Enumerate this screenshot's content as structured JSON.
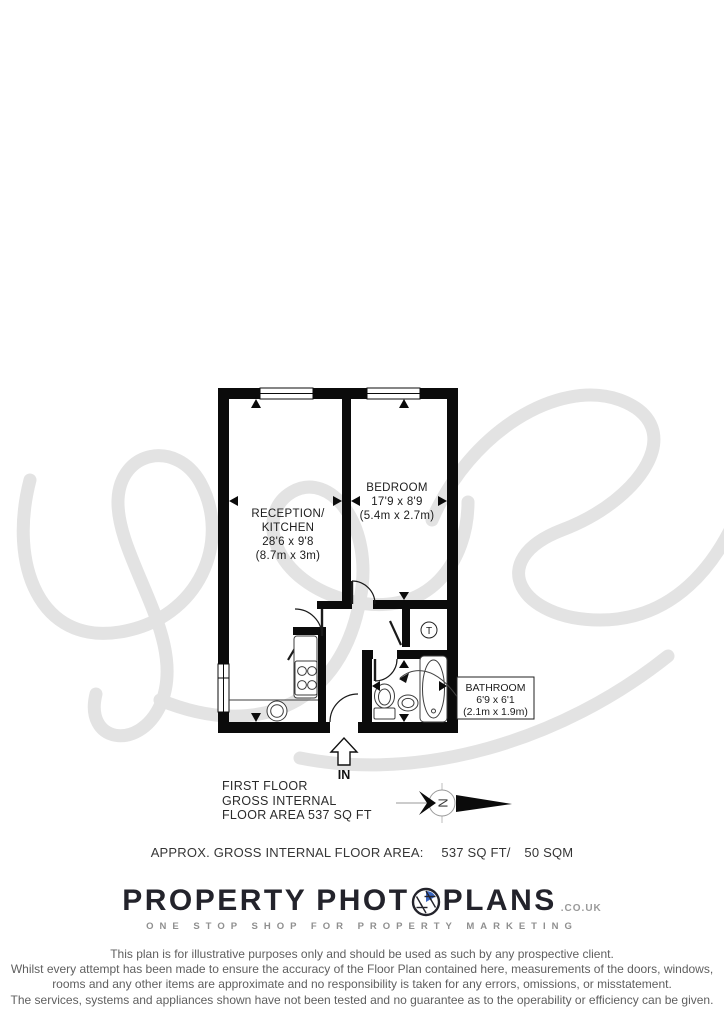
{
  "watermark_color": "#e3e3e3",
  "plan": {
    "rooms": {
      "reception": {
        "name1": "RECEPTION/",
        "name2": "KITCHEN",
        "dims_imperial": "28'6 x 9'8",
        "dims_metric": "(8.7m x 3m)"
      },
      "bedroom": {
        "name": "BEDROOM",
        "dims_imperial": "17'9 x 8'9",
        "dims_metric": "(5.4m x 2.7m)"
      },
      "bathroom": {
        "name": "BATHROOM",
        "dims_imperial": "6'9 x 6'1",
        "dims_metric": "(2.1m x 1.9m)"
      }
    },
    "entrance_label": "IN",
    "tank_symbol": "T",
    "compass_north": "N"
  },
  "floor_summary": {
    "line1": "FIRST FLOOR",
    "line2": "GROSS INTERNAL",
    "line3": "FLOOR AREA 537 SQ FT"
  },
  "area_summary": {
    "label": "APPROX. GROSS INTERNAL FLOOR AREA:",
    "imperial": "537 SQ FT/",
    "metric": "50 SQM"
  },
  "brand": {
    "word1": "PROPERTY",
    "word2": "PHOT",
    "word3": "PLANS",
    "domain": ".CO.UK",
    "tagline": "ONE STOP SHOP FOR PROPERTY MARKETING",
    "accent_color": "#3a66c0",
    "ink_color": "#23232b"
  },
  "disclaimer": {
    "line1": "This plan is for illustrative purposes only and should be used as such by any prospective client.",
    "line2": "Whilst every attempt has been made to ensure the accuracy of the Floor Plan contained here, measurements of the doors, windows,",
    "line3": "rooms and any other items are approximate and no responsibility is taken for any errors, omissions, or misstatement.",
    "line4": "The services, systems and appliances shown have not been tested and no guarantee as to the operability or efficiency can be given."
  }
}
